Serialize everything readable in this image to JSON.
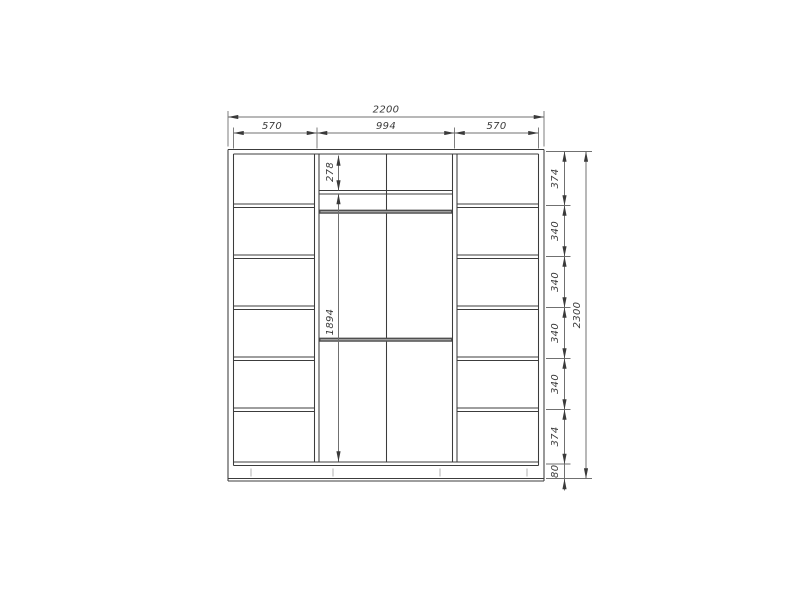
{
  "colors": {
    "background": "#ffffff",
    "line": "#3c3c3c",
    "dim_line": "#707070",
    "text": "#3a3a3a",
    "rod_dark": "#4f4f4f",
    "rod_light": "#a0a0a0",
    "plinth_tick": "#bdbdbd"
  },
  "dimensions": {
    "overall_width": "2200",
    "overall_height": "2300",
    "top_sections": [
      "570",
      "994",
      "570"
    ],
    "upper_shelf_height": "278",
    "hanging_section_height": "1894",
    "right_sections": [
      "374",
      "340",
      "340",
      "340",
      "340",
      "374",
      "80"
    ]
  }
}
